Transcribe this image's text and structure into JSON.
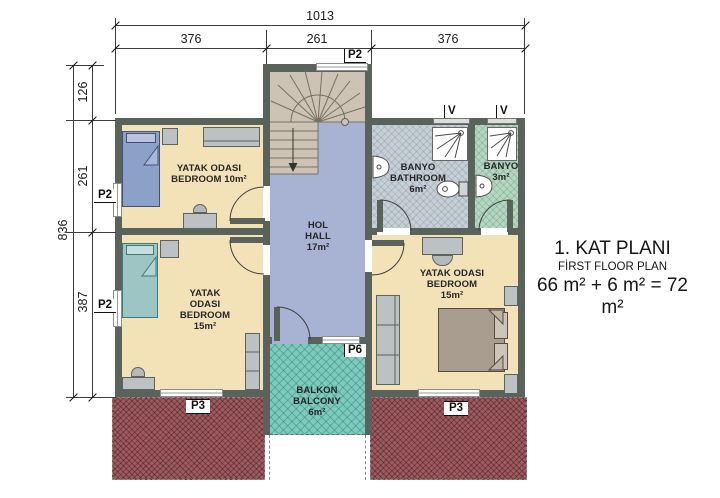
{
  "title_block": {
    "line1": "1. KAT PLANI",
    "line2": "FİRST FLOOR PLAN",
    "line3": "66 m² + 6 m² = 72 m²"
  },
  "dimensions": {
    "top_total": "1013",
    "top_left": "376",
    "top_center": "261",
    "top_right": "376",
    "left_total": "836",
    "left_top": "126",
    "left_middle": "261",
    "left_bottom": "387"
  },
  "markers": {
    "door_p2": "P2",
    "door_p3": "P3",
    "door_p6": "P6",
    "vent": "V"
  },
  "rooms": {
    "bedroom_nw": {
      "lines": [
        "YATAK ODASI",
        "BEDROOM 10m²"
      ]
    },
    "bedroom_sw": {
      "lines": [
        "YATAK",
        "ODASI",
        "BEDROOM",
        "15m²"
      ]
    },
    "hall": {
      "lines": [
        "HOL",
        "HALL",
        "17m²"
      ]
    },
    "bathroom": {
      "lines": [
        "BANYO",
        "BATHROOM",
        "6m²"
      ]
    },
    "wc": {
      "lines": [
        "BANYO",
        "3m²"
      ]
    },
    "bedroom_se": {
      "lines": [
        "YATAK ODASI",
        "BEDROOM",
        "15m²"
      ]
    },
    "balcony": {
      "lines": [
        "BALKON",
        "BALCONY",
        "6m²"
      ]
    }
  },
  "colors": {
    "wall": "#59635c",
    "bedroom_floor": "#f3e2b8",
    "hall_floor": "#a8b3d4",
    "stair_floor": "#cdc3b5",
    "bathroom_floor": "#c6cfd6",
    "wc_floor": "#b6d6c1",
    "balcony_floor": "#7ecabd",
    "roof": "#9d5a5f"
  }
}
